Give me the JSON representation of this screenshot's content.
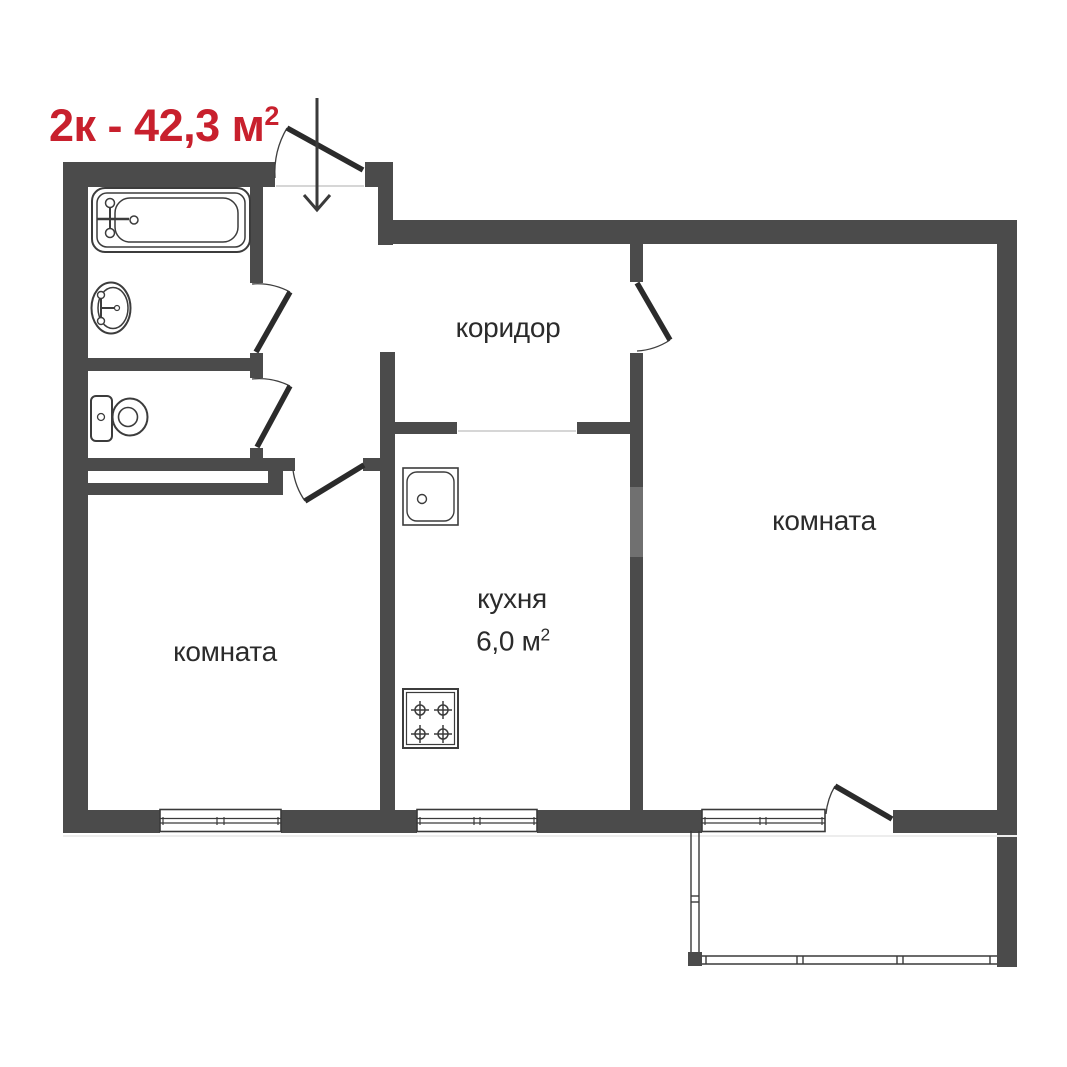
{
  "title": {
    "text": "2к - 42,3 м",
    "sup": "2"
  },
  "rooms": {
    "corridor": {
      "label": "коридор"
    },
    "kitchen": {
      "label": "кухня",
      "area": "6,0 м",
      "area_sup": "2"
    },
    "room_left": {
      "label": "комната"
    },
    "room_right": {
      "label": "комната"
    }
  },
  "fixtures": [
    "bathtub",
    "bathroom-sink",
    "toilet",
    "kitchen-sink",
    "stove-4-burners"
  ],
  "features": [
    "entrance-arrow-down",
    "built-in-closet",
    "balcony",
    "three-windows"
  ],
  "colors": {
    "background": "#ffffff",
    "wall": "#4b4b4b",
    "door": "#2b2b2b",
    "fixture_outline": "#3c3c3c",
    "label_text": "#2b2b2b",
    "title_red": "#c8202d"
  }
}
